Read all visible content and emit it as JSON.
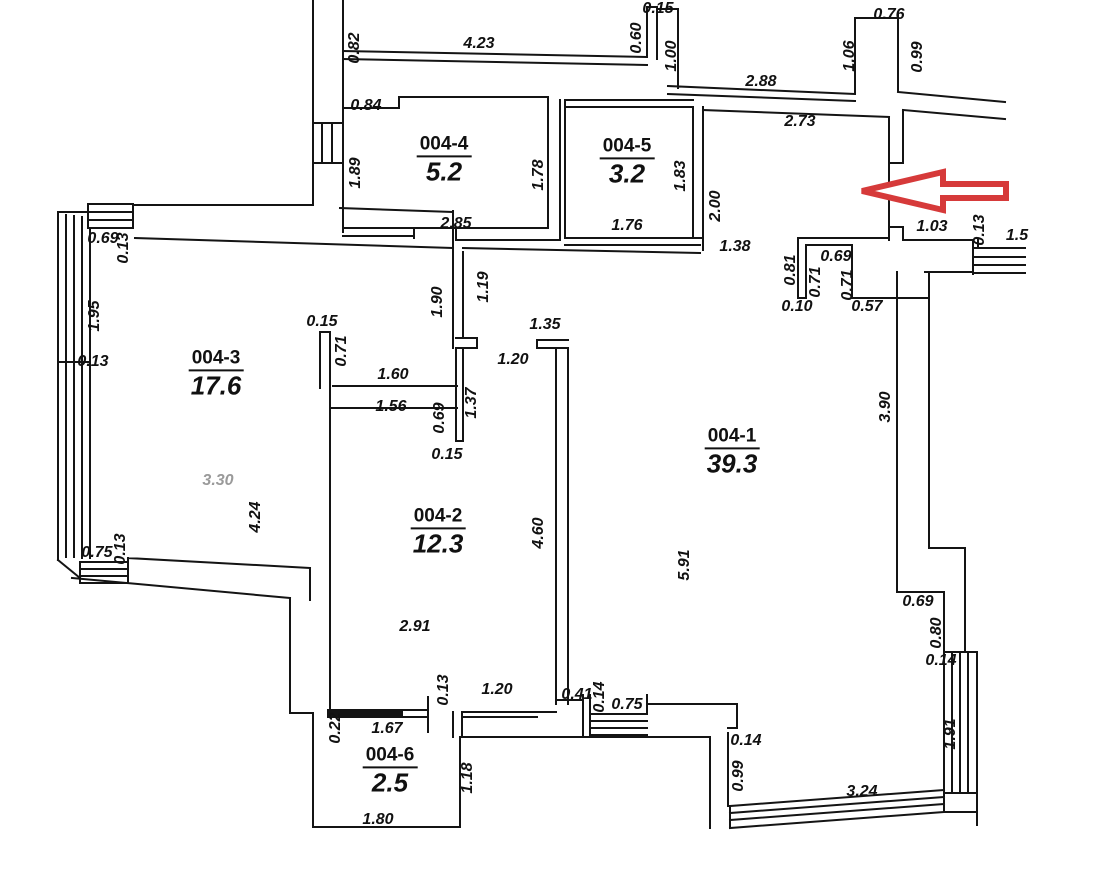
{
  "drawing_type": "apartment floor plan",
  "colors": {
    "wall": "#141414",
    "arrow": "#d63a3a",
    "dim_text": "#111111",
    "dim_gray": "#9a9a9a",
    "background": "#ffffff"
  },
  "annotations": {
    "arrow_direction": "left",
    "arrow_meaning": "entrance-pointer"
  },
  "rooms": [
    {
      "id": "004-4",
      "area": "5.2",
      "x": 444,
      "y": 160
    },
    {
      "id": "004-5",
      "area": "3.2",
      "x": 627,
      "y": 162
    },
    {
      "id": "004-3",
      "area": "17.6",
      "x": 216,
      "y": 374
    },
    {
      "id": "004-2",
      "area": "12.3",
      "x": 438,
      "y": 532
    },
    {
      "id": "004-1",
      "area": "39.3",
      "x": 732,
      "y": 452
    },
    {
      "id": "004-6",
      "area": "2.5",
      "x": 390,
      "y": 771
    }
  ],
  "dimensions": [
    {
      "label": "0.82",
      "x": 355,
      "y": 48,
      "v": 1
    },
    {
      "label": "4.23",
      "x": 479,
      "y": 44,
      "v": 0
    },
    {
      "label": "0.15",
      "x": 658,
      "y": 9,
      "v": 0
    },
    {
      "label": "0.60",
      "x": 637,
      "y": 38,
      "v": 1
    },
    {
      "label": "1.00",
      "x": 672,
      "y": 56,
      "v": 1
    },
    {
      "label": "2.88",
      "x": 761,
      "y": 82,
      "v": 0
    },
    {
      "label": "0.76",
      "x": 889,
      "y": 15,
      "v": 0
    },
    {
      "label": "1.06",
      "x": 850,
      "y": 56,
      "v": 1
    },
    {
      "label": "0.99",
      "x": 918,
      "y": 57,
      "v": 1
    },
    {
      "label": "2.73",
      "x": 800,
      "y": 122,
      "v": 0
    },
    {
      "label": "0.84",
      "x": 366,
      "y": 106,
      "v": 0
    },
    {
      "label": "1.89",
      "x": 356,
      "y": 173,
      "v": 1
    },
    {
      "label": "1.78",
      "x": 539,
      "y": 175,
      "v": 1
    },
    {
      "label": "2.85",
      "x": 456,
      "y": 224,
      "v": 0
    },
    {
      "label": "1.83",
      "x": 681,
      "y": 176,
      "v": 1
    },
    {
      "label": "1.76",
      "x": 627,
      "y": 226,
      "v": 0
    },
    {
      "label": "2.00",
      "x": 716,
      "y": 206,
      "v": 1
    },
    {
      "label": "1.38",
      "x": 735,
      "y": 247,
      "v": 0
    },
    {
      "label": "1.03",
      "x": 932,
      "y": 227,
      "v": 0
    },
    {
      "label": "0.13",
      "x": 980,
      "y": 230,
      "v": 1
    },
    {
      "label": "1.5",
      "x": 1017,
      "y": 236,
      "v": 0
    },
    {
      "label": "0.69",
      "x": 836,
      "y": 257,
      "v": 0
    },
    {
      "label": "0.81",
      "x": 791,
      "y": 270,
      "v": 1
    },
    {
      "label": "0.71",
      "x": 816,
      "y": 282,
      "v": 1
    },
    {
      "label": "0.71",
      "x": 848,
      "y": 285,
      "v": 1
    },
    {
      "label": "0.10",
      "x": 797,
      "y": 307,
      "v": 0
    },
    {
      "label": "0.57",
      "x": 867,
      "y": 307,
      "v": 0
    },
    {
      "label": "3.90",
      "x": 886,
      "y": 407,
      "v": 1
    },
    {
      "label": "0.69",
      "x": 103,
      "y": 239,
      "v": 0
    },
    {
      "label": "0.13",
      "x": 124,
      "y": 248,
      "v": 1
    },
    {
      "label": "1.95",
      "x": 95,
      "y": 316,
      "v": 1
    },
    {
      "label": "0.13",
      "x": 93,
      "y": 362,
      "v": 0
    },
    {
      "label": "3.30",
      "x": 218,
      "y": 481,
      "v": 0,
      "gray": 1
    },
    {
      "label": "4.24",
      "x": 256,
      "y": 517,
      "v": 1
    },
    {
      "label": "0.75",
      "x": 97,
      "y": 553,
      "v": 0
    },
    {
      "label": "0.13",
      "x": 121,
      "y": 549,
      "v": 1
    },
    {
      "label": "0.15",
      "x": 322,
      "y": 322,
      "v": 0
    },
    {
      "label": "0.71",
      "x": 342,
      "y": 351,
      "v": 1
    },
    {
      "label": "1.60",
      "x": 393,
      "y": 375,
      "v": 0
    },
    {
      "label": "1.56",
      "x": 391,
      "y": 407,
      "v": 0
    },
    {
      "label": "1.90",
      "x": 438,
      "y": 302,
      "v": 1
    },
    {
      "label": "1.19",
      "x": 484,
      "y": 287,
      "v": 1
    },
    {
      "label": "1.35",
      "x": 545,
      "y": 325,
      "v": 0
    },
    {
      "label": "1.20",
      "x": 513,
      "y": 360,
      "v": 0
    },
    {
      "label": "1.37",
      "x": 472,
      "y": 403,
      "v": 1
    },
    {
      "label": "0.69",
      "x": 440,
      "y": 418,
      "v": 1
    },
    {
      "label": "0.15",
      "x": 447,
      "y": 455,
      "v": 0
    },
    {
      "label": "2.91",
      "x": 415,
      "y": 627,
      "v": 0
    },
    {
      "label": "4.60",
      "x": 539,
      "y": 533,
      "v": 1
    },
    {
      "label": "5.91",
      "x": 685,
      "y": 565,
      "v": 1
    },
    {
      "label": "0.69",
      "x": 918,
      "y": 602,
      "v": 0
    },
    {
      "label": "0.80",
      "x": 937,
      "y": 633,
      "v": 1
    },
    {
      "label": "0.14",
      "x": 941,
      "y": 661,
      "v": 0
    },
    {
      "label": "0.13",
      "x": 444,
      "y": 690,
      "v": 1
    },
    {
      "label": "1.20",
      "x": 497,
      "y": 690,
      "v": 0
    },
    {
      "label": "0.41",
      "x": 577,
      "y": 695,
      "v": 0
    },
    {
      "label": "0.14",
      "x": 600,
      "y": 697,
      "v": 1
    },
    {
      "label": "0.75",
      "x": 627,
      "y": 705,
      "v": 0
    },
    {
      "label": "0.22",
      "x": 336,
      "y": 728,
      "v": 1
    },
    {
      "label": "1.67",
      "x": 387,
      "y": 729,
      "v": 0
    },
    {
      "label": "1.18",
      "x": 468,
      "y": 778,
      "v": 1
    },
    {
      "label": "1.80",
      "x": 378,
      "y": 820,
      "v": 0
    },
    {
      "label": "0.14",
      "x": 746,
      "y": 741,
      "v": 0
    },
    {
      "label": "0.99",
      "x": 739,
      "y": 776,
      "v": 1
    },
    {
      "label": "3.24",
      "x": 862,
      "y": 792,
      "v": 0
    },
    {
      "label": "1.91",
      "x": 951,
      "y": 734,
      "v": 1
    }
  ]
}
